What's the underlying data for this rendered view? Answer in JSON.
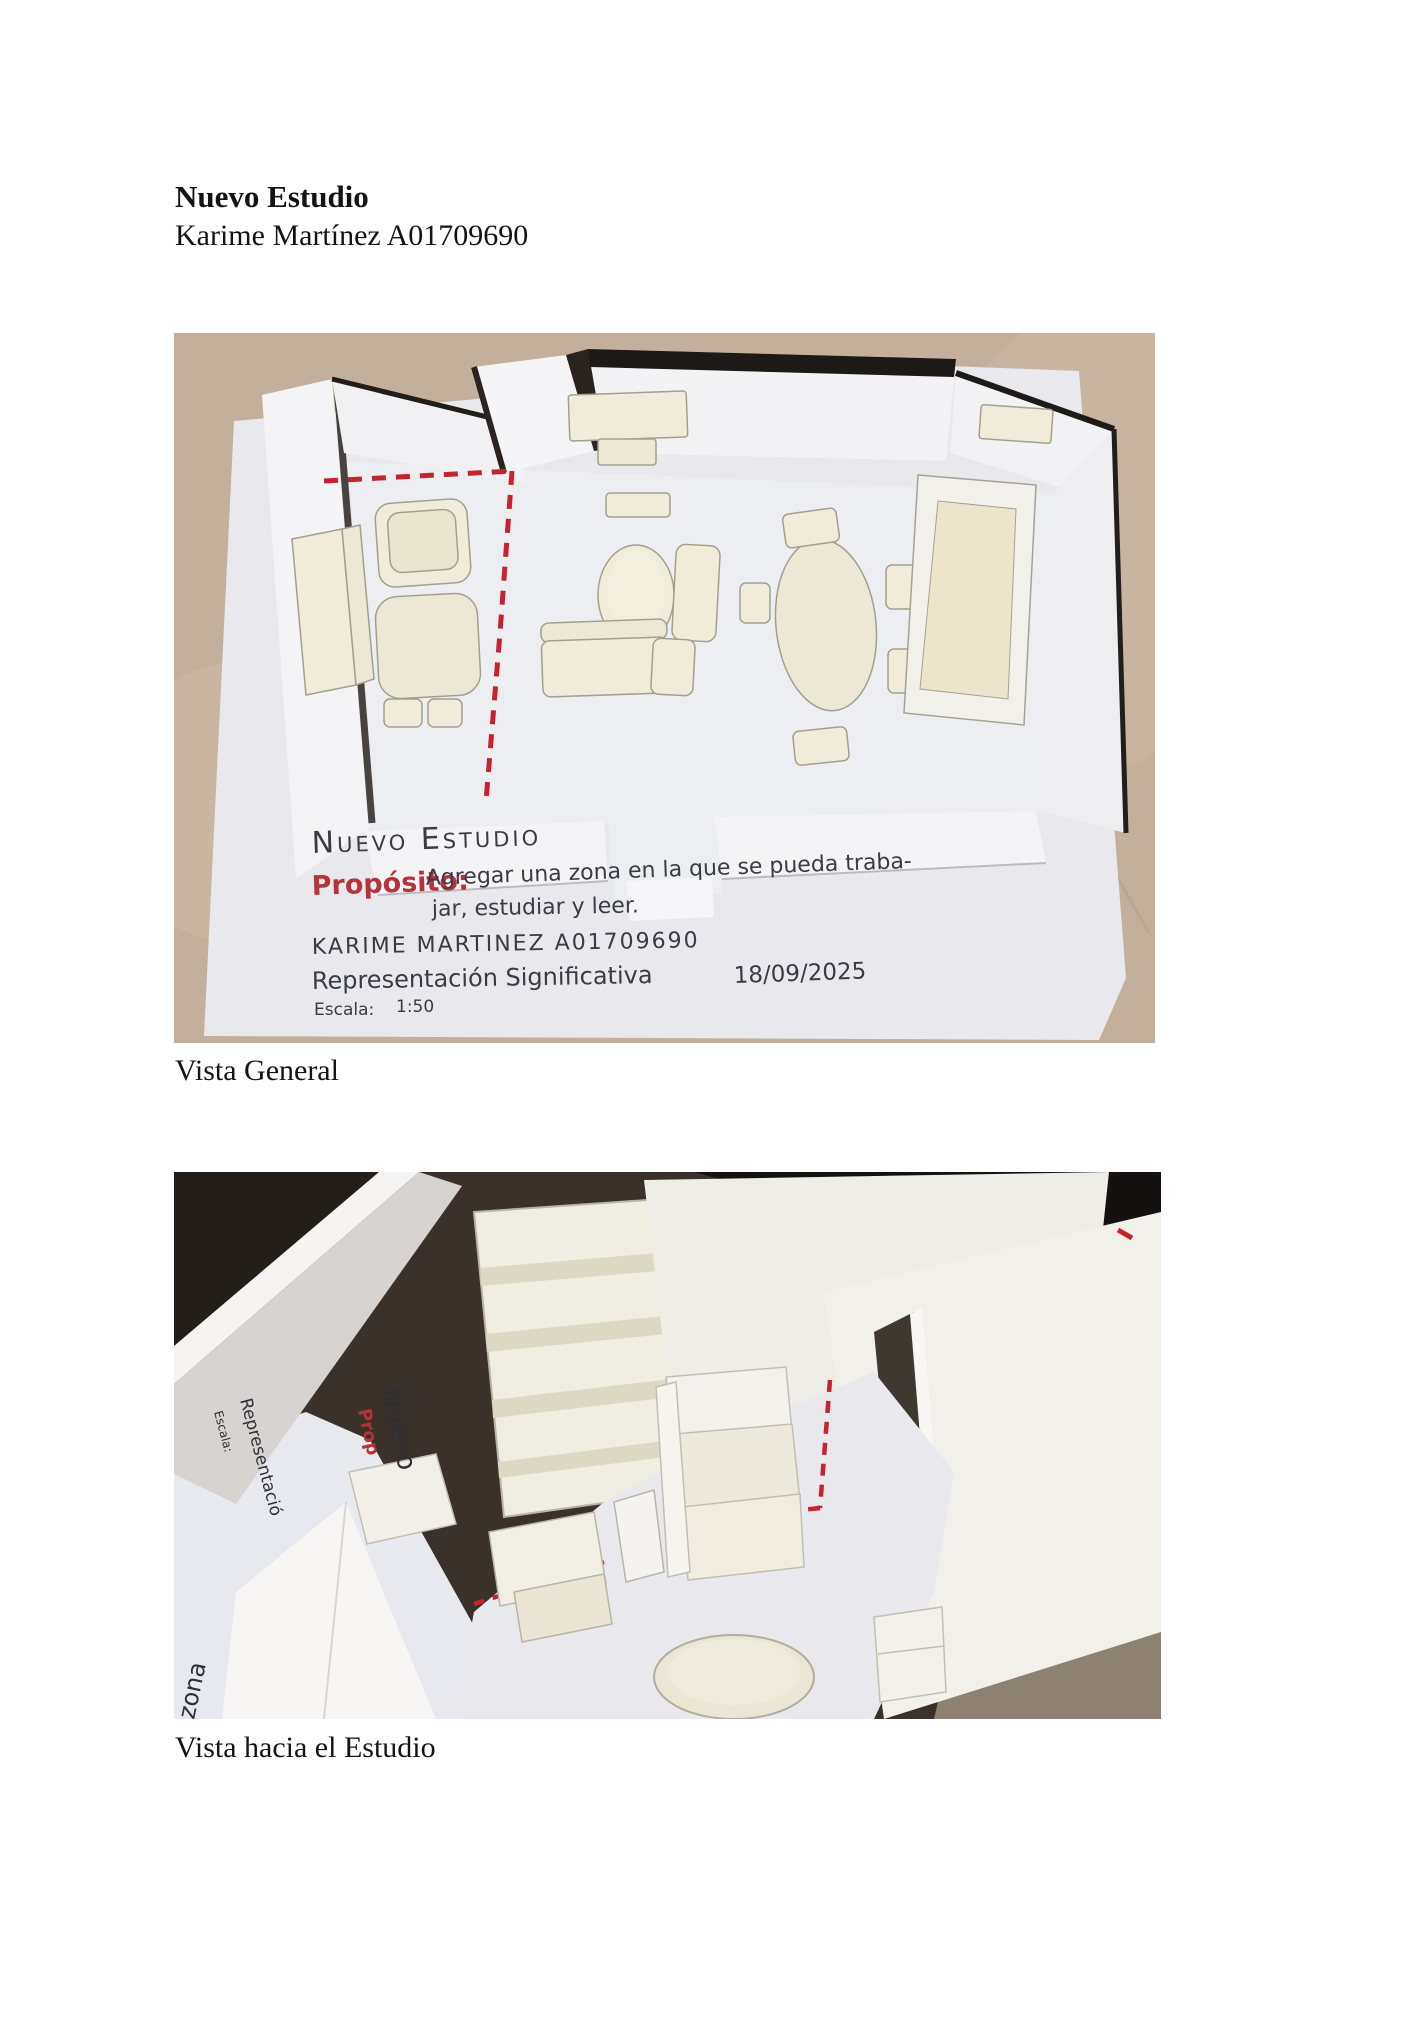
{
  "document": {
    "title": "Nuevo Estudio",
    "author": "Karime Martínez A01709690",
    "figure1_caption": "Vista General",
    "figure2_caption": "Vista hacia el Estudio"
  },
  "model_card": {
    "title": "Nuevo Estudio",
    "purpose_label": "Propósito:",
    "purpose_line1": "Agregar una zona en la que se pueda traba-",
    "purpose_line2": "jar, estudiar y leer.",
    "author": "KARIME MARTINEZ A01709690",
    "representation": "Representación Significativa",
    "date": "18/09/2025",
    "scale_label": "Escala:",
    "scale_value": "1:50"
  },
  "photo2_labels": {
    "rotated_title": "Nuevo",
    "rotated_purpose": "Prop",
    "rotated_representation": "Representació",
    "rotated_scale": "Escala:",
    "rotated_zone": "zona"
  },
  "colors": {
    "cardboard_tan": "#c3b09c",
    "paper_white": "#e8e8ed",
    "model_cream": "#f0ecd9",
    "wall_white": "#f4f3f5",
    "shadow_black": "#1e1a17",
    "marker_red": "#c5232e",
    "ink_dark": "#3b3b44",
    "ink_red": "#b5333b",
    "photo2_background": "#3a322a"
  }
}
